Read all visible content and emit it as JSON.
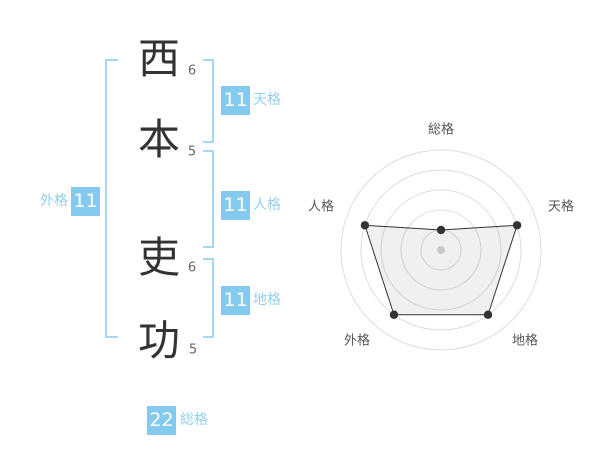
{
  "ui_colors": {
    "background": "#ffffff",
    "badge_bg": "#84c9ee",
    "badge_text": "#ffffff",
    "side_label": "#94cff0",
    "bracket": "#a5d8f3",
    "kanji": "#333333",
    "stroke_num": "#666666"
  },
  "name_diagram": {
    "chars": [
      {
        "char": "西",
        "strokes": "6"
      },
      {
        "char": "本",
        "strokes": "5"
      },
      {
        "char": "吏",
        "strokes": "6"
      },
      {
        "char": "功",
        "strokes": "5"
      }
    ],
    "badges": [
      {
        "id": "tenkaku",
        "value": "11",
        "label": "天格"
      },
      {
        "id": "jinkaku",
        "value": "11",
        "label": "人格"
      },
      {
        "id": "chikaku",
        "value": "11",
        "label": "地格"
      },
      {
        "id": "gaikaku",
        "value": "11",
        "label": "外格"
      },
      {
        "id": "soukaku",
        "value": "22",
        "label": "総格"
      }
    ]
  },
  "chart_data": {
    "type": "radar",
    "title": "",
    "axes": [
      "総格",
      "天格",
      "地格",
      "外格",
      "人格"
    ],
    "values": [
      22,
      11,
      11,
      11,
      11
    ],
    "plot_levels": [
      1,
      4,
      4,
      4,
      4
    ],
    "rings": 5,
    "ring_step_px": 20,
    "angles_deg": [
      90,
      18,
      -54,
      -126,
      162
    ],
    "legend": "none",
    "grid": "circular",
    "colors": {
      "ring": "#dddddd",
      "polygon_fill": "rgba(0,0,0,0.06)",
      "polygon_stroke": "#333333",
      "marker": "#333333",
      "center_dot": "#c9c9c9",
      "label": "#555555"
    }
  }
}
